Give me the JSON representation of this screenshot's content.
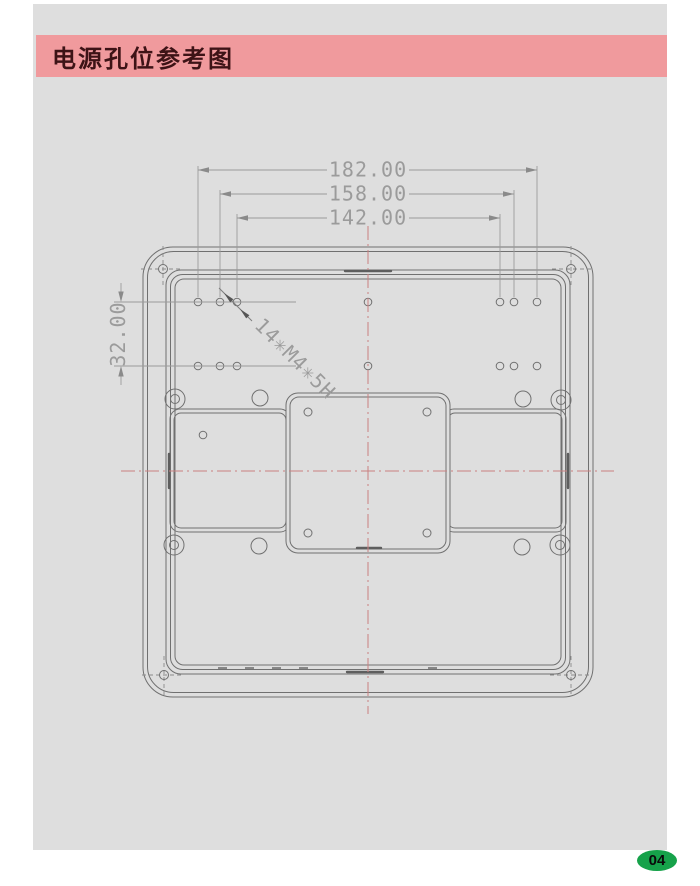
{
  "page": {
    "title": "电源孔位参考图",
    "page_number": "04",
    "colors": {
      "canvas_gray": "#dedede",
      "title_bar_pink": "#f09a9d",
      "title_text": "#3d1316",
      "badge_green": "#16a24a",
      "geometry_line": "#707070",
      "dimension_gray": "#9b9b9b",
      "centerline_red": "#c98080"
    }
  },
  "drawing": {
    "dim_width_outer": "182.00",
    "dim_width_mid": "158.00",
    "dim_width_inner": "142.00",
    "dim_row_spacing": "32.00",
    "hole_annotation": "14✳M4✳5H"
  }
}
